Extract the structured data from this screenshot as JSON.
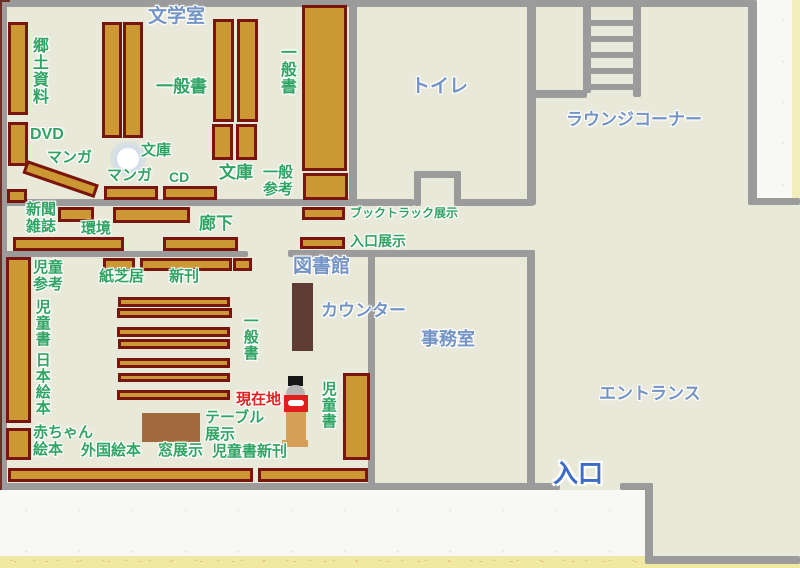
{
  "map_title": "library-floor-map",
  "colors": {
    "floor": "#e9e9da",
    "wall": "#9b9b9b",
    "shelf_fill": "#cc9834",
    "shelf_border": "#7a150e",
    "label_green": "#2fa463",
    "label_blue": "#7494c6",
    "label_blue_strong": "#3b6cc7",
    "label_red": "#e32020",
    "counter_brown": "#5e3c34",
    "table_brown": "#a06a3c",
    "outside_paper": "#f8f8f5",
    "edge_yellow": "#f0e9a2"
  },
  "icons": {
    "pillar": "white-circle-pillar",
    "stairs": "ladder-stairs",
    "current_location_marker": "person-at-stand"
  },
  "labels": {
    "literature_room": "文学室",
    "toilet": "トイレ",
    "lounge_corner": "ラウンジコーナー",
    "library": "図書館",
    "counter": "カウンター",
    "office": "事務室",
    "entrance_hall": "エントランス",
    "entrance": "入口",
    "local_materials": "郷土資料",
    "dvd": "DVD",
    "manga_a": "マンガ",
    "manga_b": "マンガ",
    "cd": "CD",
    "bunko_a": "文庫",
    "bunko_b": "文庫",
    "general_books_a": "一般書",
    "general_books_b": "一般書",
    "general_books_c": "一般書",
    "general_reference": "一般\n参考",
    "newspapers_magazines": "新聞\n雑誌",
    "environment": "環境",
    "corridor": "廊下",
    "booktruck_display": "ブックトラック展示",
    "entrance_display": "入口展示",
    "children_reference": "児童\n参考",
    "children_books_a": "児童書",
    "japanese_picture_books": "日本絵本",
    "baby_picture_books": "赤ちゃん\n絵本",
    "foreign_picture_books": "外国絵本",
    "window_display": "窓展示",
    "children_new_books": "児童書新刊",
    "kamishibai": "紙芝居",
    "new_books": "新刊",
    "table_display": "テーブル\n展示",
    "children_books_b": "児童書",
    "current_location": "現在地"
  }
}
